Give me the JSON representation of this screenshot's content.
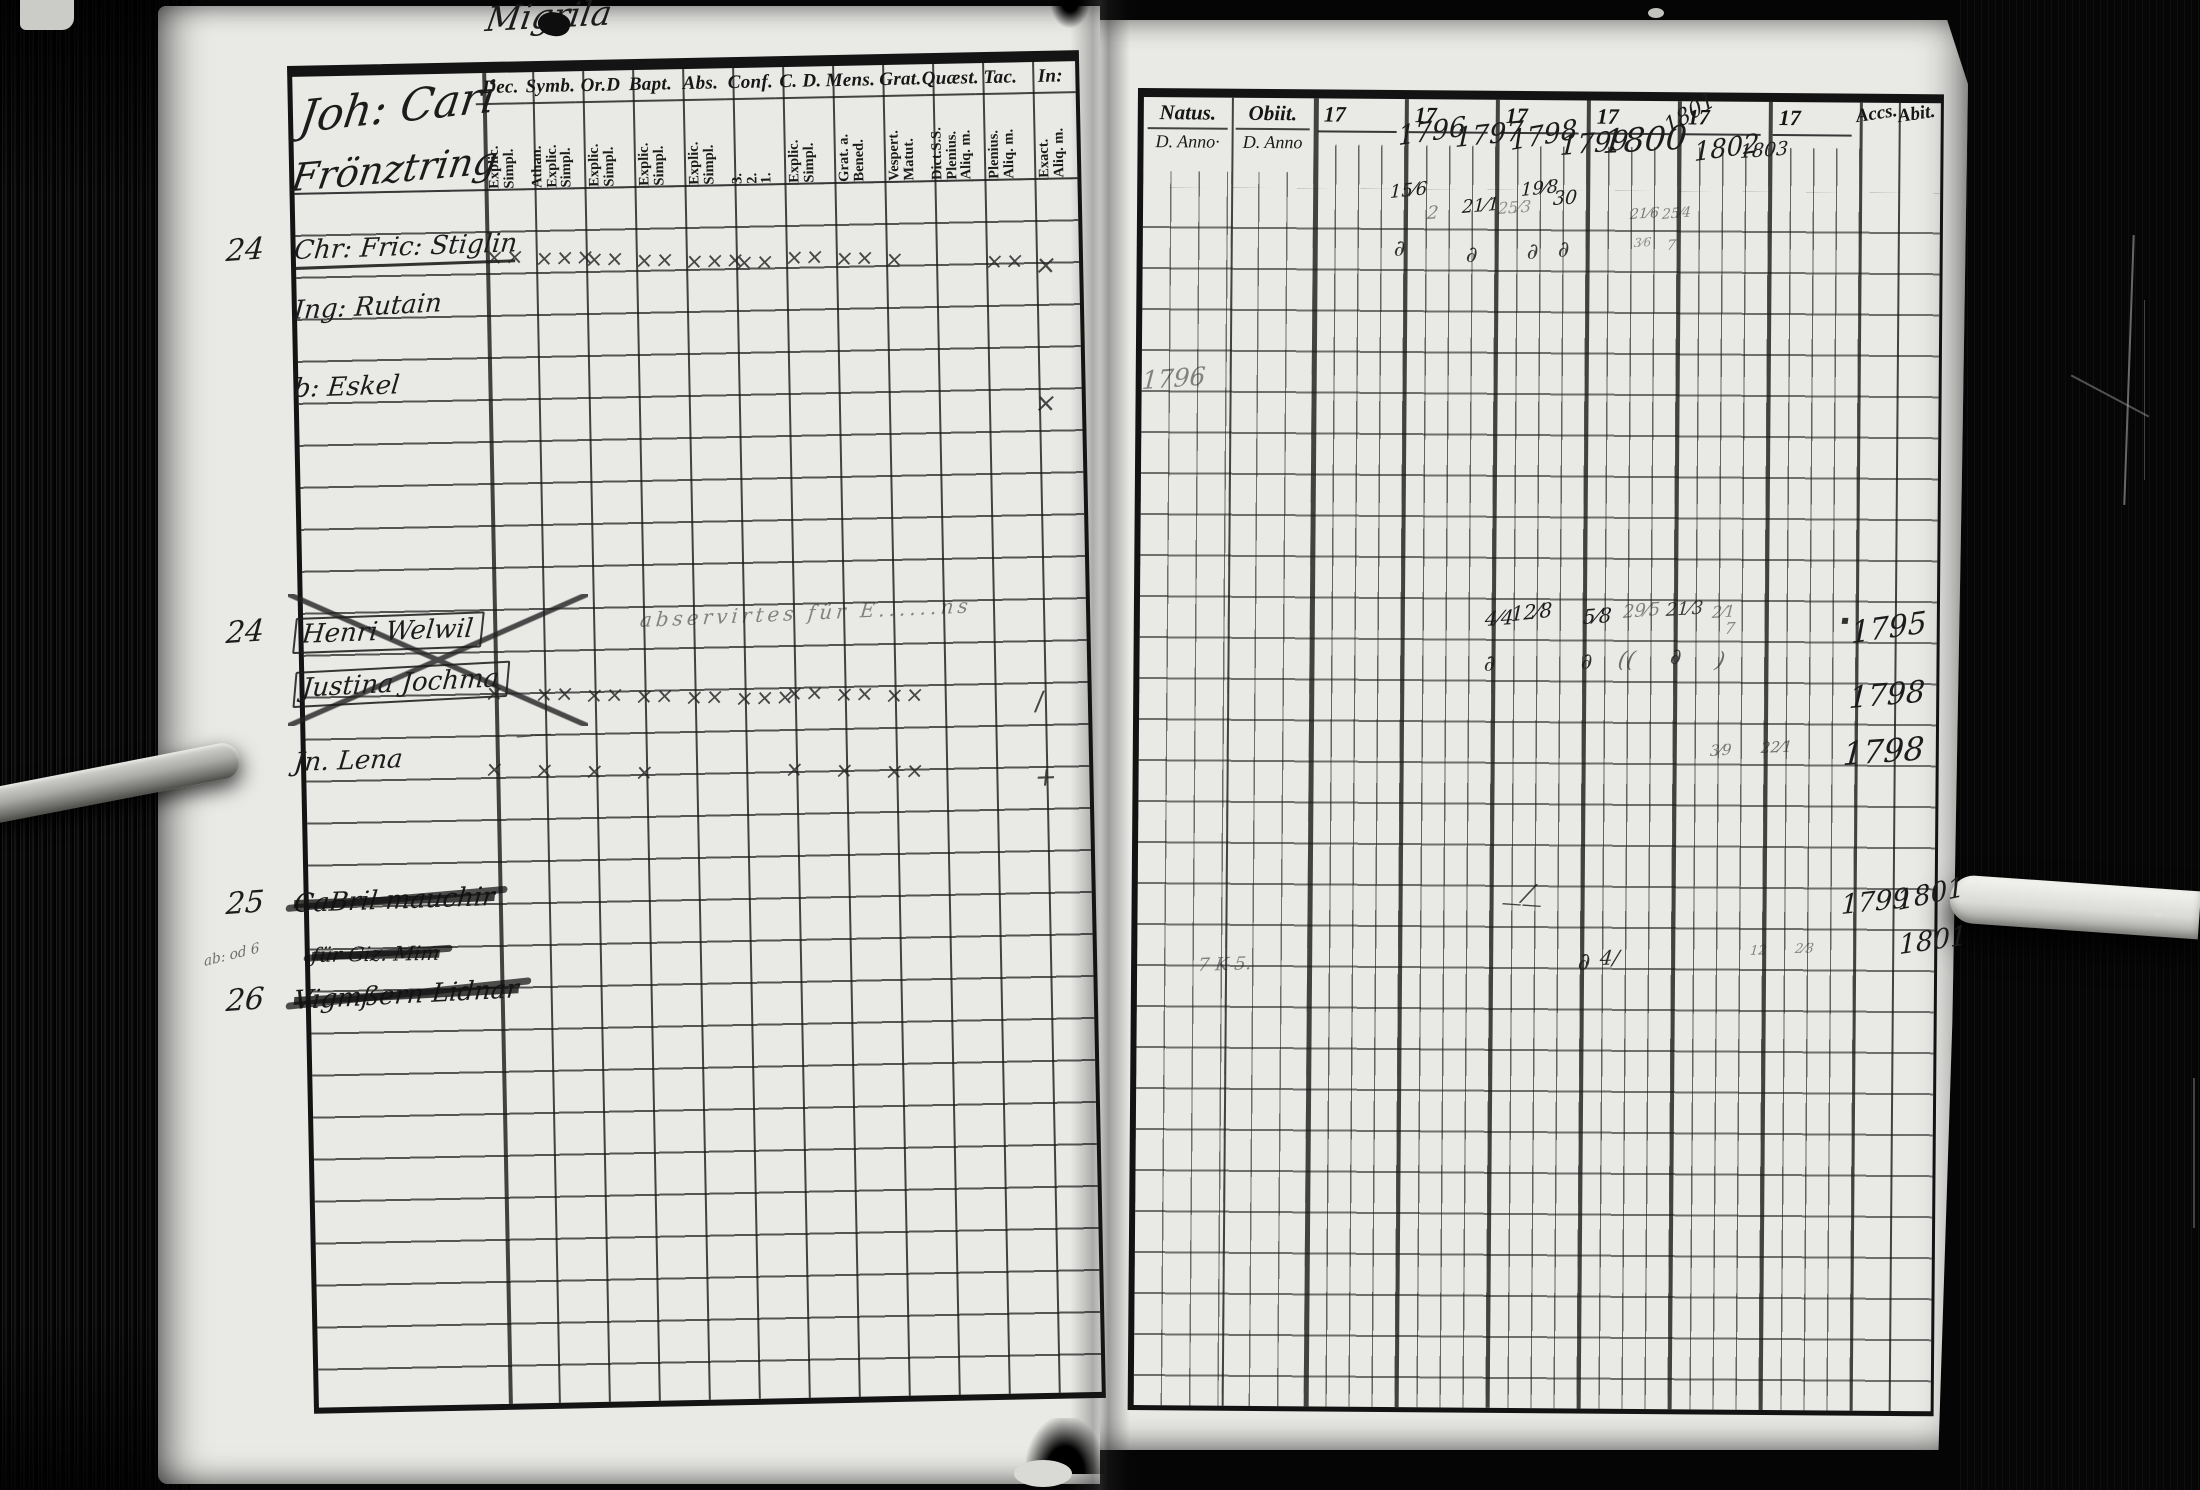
{
  "page_title": "Migrila",
  "left_page": {
    "inscription_line1": "Joh: Cari",
    "inscription_line2": "Frönztring",
    "columns": [
      {
        "label": "Dec.",
        "sub": [
          "Explic.",
          "Simpl."
        ]
      },
      {
        "label": "Symb.",
        "sub": [
          "Athan.",
          "Explic.",
          "Simpl."
        ]
      },
      {
        "label": "Or.D",
        "sub": [
          "Explic.",
          "Simpl."
        ]
      },
      {
        "label": "Bapt.",
        "sub": [
          "Explic.",
          "Simpl."
        ]
      },
      {
        "label": "Abs.",
        "sub": [
          "Explic.",
          "Simpl."
        ]
      },
      {
        "label": "Conf.",
        "sub": [
          "3.",
          "2.",
          "1."
        ]
      },
      {
        "label": "C. D.",
        "sub": [
          "Explic.",
          "Simpl."
        ]
      },
      {
        "label": "Mens.",
        "sub": [
          "Grat. a.",
          "Bened."
        ]
      },
      {
        "label": "Grat.",
        "sub": [
          "Vespert.",
          "Matut."
        ]
      },
      {
        "label": "Quæst.",
        "sub": [
          "Dict.S.S.",
          "Plenius.",
          "Aliq. m."
        ]
      },
      {
        "label": "Tac.",
        "sub": [
          "Plenius.",
          "Aliq. m."
        ]
      },
      {
        "label": "In:",
        "sub": [
          "Exact.",
          "Aliq. m."
        ]
      }
    ],
    "entries": [
      {
        "no": "24",
        "name": "Chr: Fric: Stiglin",
        "underline": true,
        "marks": [
          "××",
          "×××",
          "××",
          "××",
          "×××",
          "××",
          "××",
          "××",
          "×",
          "",
          "××",
          "×"
        ]
      },
      {
        "no": "",
        "name": "Ing: Rutain",
        "marks": []
      },
      {
        "no": "",
        "name": "b: Eskel",
        "marks": [
          "",
          "",
          "",
          "",
          "",
          "",
          "",
          "",
          "",
          "",
          "",
          "×"
        ]
      },
      {
        "no": "24",
        "name": "Henri Welwil",
        "boxed": true,
        "note": "abservirtes für E......ns"
      },
      {
        "no": "",
        "name": "Justina Jochma",
        "boxed": true,
        "marks": [
          "×",
          "××",
          "××",
          "××",
          "××",
          "×××",
          "××",
          "××",
          "××",
          "",
          "",
          "∕"
        ]
      },
      {
        "no": "",
        "name": "Jn. Lena",
        "marks": [
          "×",
          "×",
          "×",
          "×",
          "",
          "",
          "×",
          "×",
          "××",
          "",
          "",
          "+"
        ]
      },
      {
        "no": "25",
        "name": "CaBril mauchir",
        "scribbled": true
      },
      {
        "no": "",
        "name": "für Giz. Mim",
        "scribbled": true
      },
      {
        "no": "26",
        "name": "Vigmßern Lidnar",
        "scribbled": true,
        "marginal": "ab: od 6"
      }
    ],
    "annotations": {
      "dash": "——"
    }
  },
  "right_page": {
    "natus": {
      "label": "Natus.",
      "sub": "D. Anno·"
    },
    "obiit": {
      "label": "Obiit.",
      "sub": "D. Anno"
    },
    "decade_label": "17",
    "accs_label": "Accs.",
    "abit_label": "Abit.",
    "years_written": [
      "1796",
      "1797",
      "1798",
      "1799",
      "1800",
      "1801",
      "1802",
      "1803"
    ],
    "annotations": {
      "natus_year": "1796",
      "m1": "15⁄6",
      "m1d": "∂",
      "m2": "2",
      "m3": "21⁄1",
      "m3d": "∂",
      "m4": "25⁄3",
      "m5": "19⁄8",
      "m6": "30",
      "m5d": "∂",
      "m6d": "∂",
      "m7": "21⁄6",
      "m7b": "3⁄6",
      "m8": "25⁄4",
      "m8b": "7",
      "w1": "4⁄4",
      "w2": "12⁄8",
      "w1d": "∂",
      "w3": "5⁄8",
      "w3d": "∂",
      "w4": "29⁄5",
      "w4c": "((",
      "w5": "21⁄3",
      "w5d": "∂",
      "w6": "2⁄1",
      "w6c": ")",
      "w7": "7",
      "wdot": "▪",
      "wy1": "1795",
      "wy2": "1798",
      "l1": "3⁄9",
      "l2": "22⁄1",
      "ly": "1798",
      "g1": "——",
      "g2": "∕",
      "y25a": "1799",
      "y25b": "1801",
      "y25c": "1801",
      "x26a": "∂",
      "x26b": "4∕",
      "x26c": "7 K 5.",
      "x26d": "12",
      "x26e": "2⁄3"
    }
  }
}
